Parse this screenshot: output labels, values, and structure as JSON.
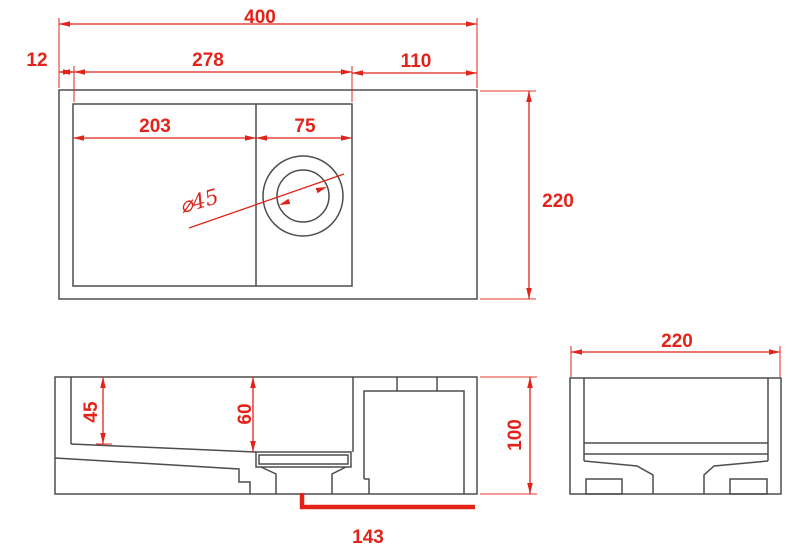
{
  "title": "wall-hung-basin-technical-drawing",
  "colors": {
    "dimension_red": "#e2231a",
    "line_gray": "#4d4d4d",
    "background": "#ffffff"
  },
  "views": {
    "top": {
      "overall_width": "400",
      "left_wall": "12",
      "inner_width": "278",
      "deck_width": "110",
      "bowl_width": "203",
      "drain_zone_width": "75",
      "drain_diameter": "⌀45",
      "overall_depth": "220"
    },
    "front": {
      "bowl_depth_left": "45",
      "bowl_depth_drain": "60",
      "overall_height": "100",
      "drain_offset": "143"
    },
    "side": {
      "overall_depth": "220"
    }
  }
}
